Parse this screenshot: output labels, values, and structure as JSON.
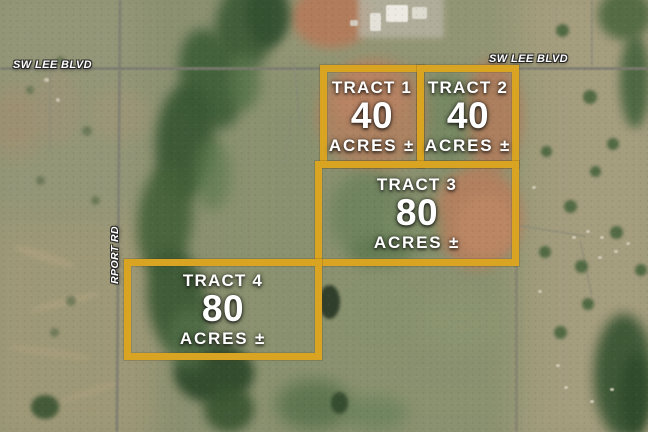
{
  "image": {
    "road_labels": {
      "lee_blvd_left": "SW LEE BLVD",
      "lee_blvd_right": "SW LEE BLVD",
      "airport_rd_partial": "RPORT RD"
    },
    "tracts": [
      {
        "name": "TRACT 1",
        "acres": "40",
        "unit": "ACRES ±"
      },
      {
        "name": "TRACT 2",
        "acres": "40",
        "unit": "ACRES ±"
      },
      {
        "name": "TRACT 3",
        "acres": "80",
        "unit": "ACRES ±"
      },
      {
        "name": "TRACT 4",
        "acres": "80",
        "unit": "ACRES ±"
      }
    ],
    "colors": {
      "tract_border": "#D9A422",
      "tract_text": "#FFFFFF",
      "road_label_text": "#FFFFFF"
    }
  }
}
